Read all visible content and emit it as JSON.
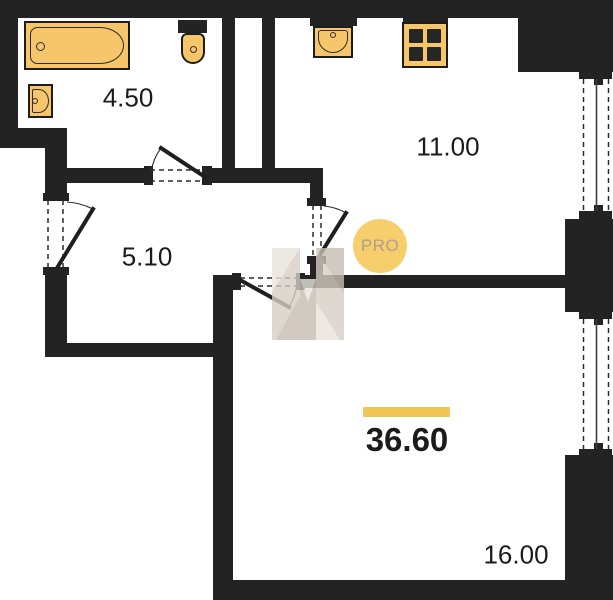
{
  "plan": {
    "total": {
      "area": "36.60"
    },
    "rooms": [
      {
        "name": "bathroom",
        "area": "4.50"
      },
      {
        "name": "kitchen",
        "area": "11.00"
      },
      {
        "name": "hallway",
        "area": "5.10"
      },
      {
        "name": "living-room",
        "area": "16.00"
      }
    ],
    "watermark_badge": "PRO"
  },
  "icons": {
    "bathtub": "bathtub-icon",
    "bathroom_sink": "sink-icon",
    "toilet": "toilet-icon",
    "kitchen_sink": "kitchen-sink-icon",
    "stove": "stove-icon",
    "logo": "h-logo-icon"
  },
  "colors": {
    "wall": "#232323",
    "fixture": "#f7c66a",
    "fixture-border": "#1d1d1d",
    "line": "#2b2b2b",
    "badge-bg": "#f7ce6c",
    "badge-text": "#afa08c",
    "accent-bar": "#f2c557",
    "label-text": "#1b1b1b",
    "wm-light": "#e9e4dc",
    "wm-mid": "#d6cfc5",
    "wm-dark": "#c7beb2"
  }
}
